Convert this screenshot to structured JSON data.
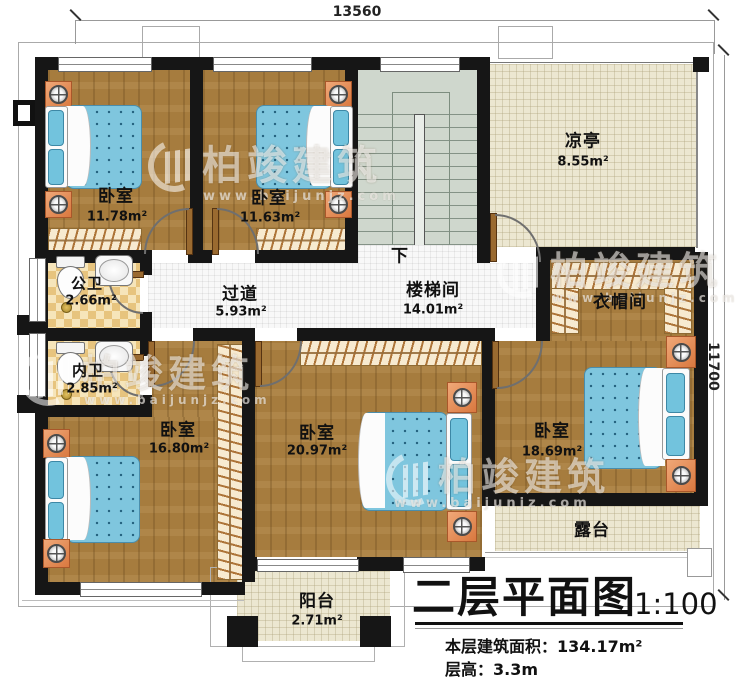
{
  "dimensions": {
    "width": "13560",
    "height": "11700"
  },
  "rooms": {
    "bedroom1": {
      "name": "卧室",
      "area": "11.78m²"
    },
    "bedroom2": {
      "name": "卧室",
      "area": "11.63m²"
    },
    "stairwell": {
      "name": "楼梯间",
      "area": "14.01m²"
    },
    "pavilion": {
      "name": "凉亭",
      "area": "8.55m²"
    },
    "public_bath": {
      "name": "公卫",
      "area": "2.66m²"
    },
    "private_bath": {
      "name": "内卫",
      "area": "2.85m²"
    },
    "hallway": {
      "name": "过道",
      "area": "5.93m²"
    },
    "cloakroom": {
      "name": "衣帽间"
    },
    "bedroom3": {
      "name": "卧室",
      "area": "16.80m²"
    },
    "bedroom4": {
      "name": "卧室",
      "area": "20.97m²"
    },
    "bedroom5": {
      "name": "卧室",
      "area": "18.69m²"
    },
    "terrace": {
      "name": "露台"
    },
    "balcony": {
      "name": "阳台",
      "area": "2.71m²"
    }
  },
  "annotations": {
    "stairs_down": "下"
  },
  "title_block": {
    "title": "二层平面图",
    "scale": "1:100",
    "floor_area_label": "本层建筑面积：",
    "floor_area_value": "134.17m²",
    "floor_height_label": "层高：",
    "floor_height_value": "3.3m"
  },
  "watermark": {
    "brand": "柏竣建筑",
    "url": "www.baijunjz.com"
  },
  "colors": {
    "wall": "#161616",
    "wood_floor": "#a67c3e",
    "bed_blue": "#7fc6de",
    "tile_tan": "#e7c47e",
    "stair_green": "#cfd7cd",
    "outdoor_cream": "#ece7d1"
  }
}
